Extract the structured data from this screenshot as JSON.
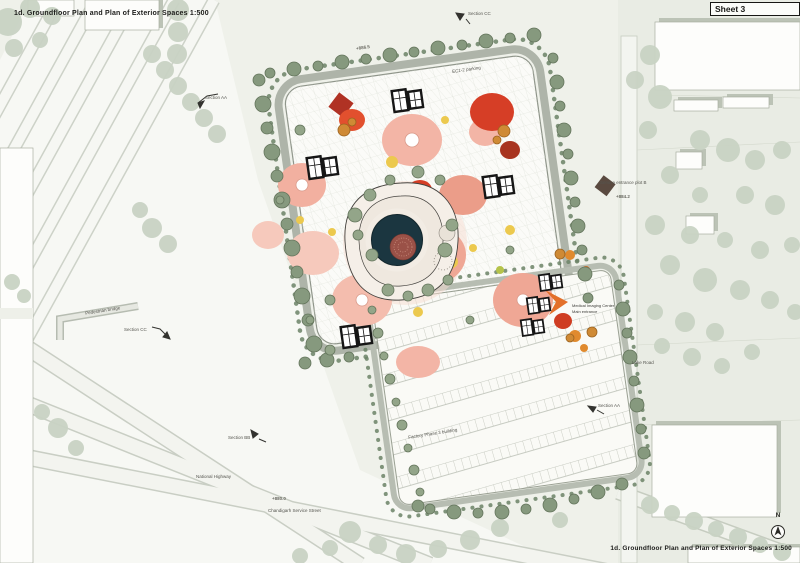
{
  "sheet": {
    "title_top": "1d. Groundfloor Plan and Plan of Exterior Spaces 1:500",
    "sheet_label": "Sheet 3",
    "title_bottom": "1d. Groundfloor Plan and Plan of Exterior Spaces 1:500"
  },
  "annotations": {
    "section_aa_top": "Section AA",
    "section_cc_top": "Section CC",
    "section_cc_left": "Section CC",
    "section_bb": "Section BB",
    "section_aa_right": "Section AA",
    "pedestrian_bridge": "Pedestrian bridge",
    "national_highway": "National Highway",
    "chandigarh_service_street": "Chandigarh Service Street",
    "service_entrance": "Service entrance plot B",
    "lake_road": "Lake Road",
    "factory_building": "Factory Phase 3 building",
    "medical_line1": "Medical Imaging Center",
    "medical_line2": "Main entrance",
    "ec_parking": "EC1-2 parking",
    "elev_1": "+886.5",
    "elev_2": "+884.2",
    "elev_3": "+880.0"
  },
  "compass": {
    "north": "N"
  },
  "colors": {
    "background": "#eff1ea",
    "context_green": "#c9d3c4",
    "site_tree_green": "#86997e",
    "pond_teal": "#1b3640",
    "island_rust": "#9a5147",
    "courtyard_salmon": "#f2b3a4",
    "accent_red": "#d63e26",
    "accent_orange": "#e0822f",
    "accent_yellow": "#ecc94e",
    "road_grey": "#aeb4a9"
  }
}
